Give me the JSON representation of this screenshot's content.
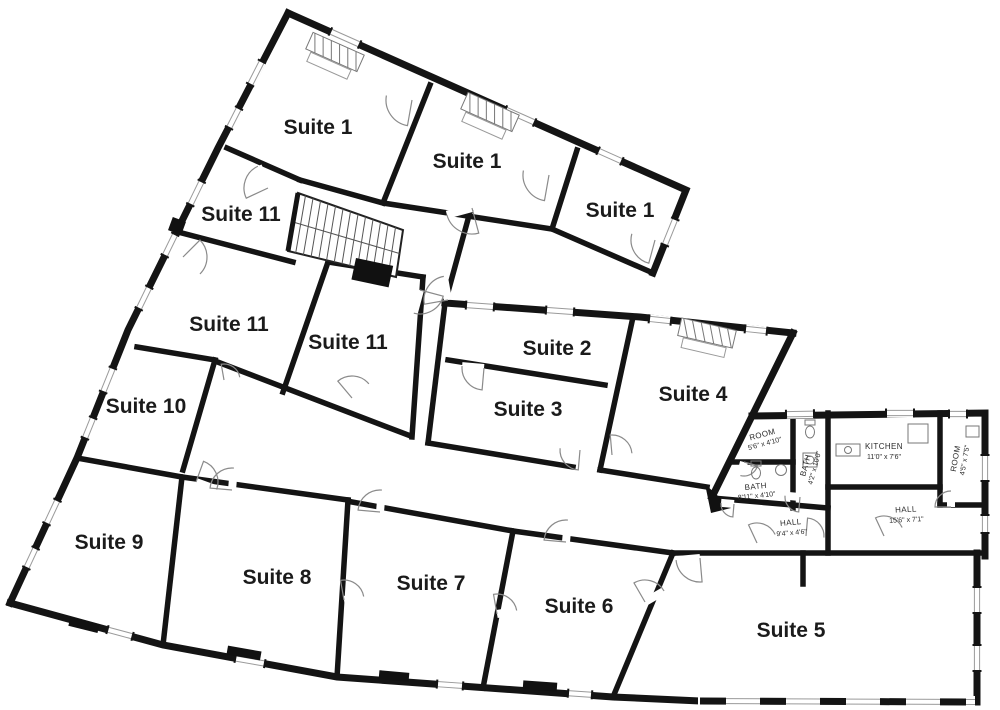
{
  "page": {
    "background": "#ffffff",
    "wall_color": "#141414",
    "figure": "office-floor-plan"
  },
  "plan": {
    "suites": [
      {
        "id": "suite-1-main",
        "label": "Suite 1"
      },
      {
        "id": "suite-1-mid",
        "label": "Suite 1"
      },
      {
        "id": "suite-1-east",
        "label": "Suite 1"
      },
      {
        "id": "suite-11-north",
        "label": "Suite 11"
      },
      {
        "id": "suite-11-west",
        "label": "Suite 11"
      },
      {
        "id": "suite-11-center",
        "label": "Suite 11"
      },
      {
        "id": "suite-10",
        "label": "Suite 10"
      },
      {
        "id": "suite-2",
        "label": "Suite 2"
      },
      {
        "id": "suite-3",
        "label": "Suite 3"
      },
      {
        "id": "suite-4",
        "label": "Suite 4"
      },
      {
        "id": "suite-9",
        "label": "Suite 9"
      },
      {
        "id": "suite-8",
        "label": "Suite 8"
      },
      {
        "id": "suite-7",
        "label": "Suite 7"
      },
      {
        "id": "suite-6",
        "label": "Suite 6"
      },
      {
        "id": "suite-5",
        "label": "Suite 5"
      }
    ],
    "rooms": [
      {
        "id": "room-small",
        "name": "ROOM",
        "dims": "5'6\" x 4'10\""
      },
      {
        "id": "bath-main",
        "name": "BATH",
        "dims": "8'11\" x 4'10\""
      },
      {
        "id": "bath-narrow",
        "name": "BATH",
        "dims": "4'2\" x 10'0\""
      },
      {
        "id": "kitchen",
        "name": "KITCHEN",
        "dims": "11'0\" x 7'6\""
      },
      {
        "id": "room-east",
        "name": "ROOM",
        "dims": "4'5\" x 7'5\""
      },
      {
        "id": "hall-long",
        "name": "HALL",
        "dims": "15'6\" x 7'1\""
      },
      {
        "id": "hall-small",
        "name": "HALL",
        "dims": "9'4\" x 4'6\""
      }
    ]
  }
}
